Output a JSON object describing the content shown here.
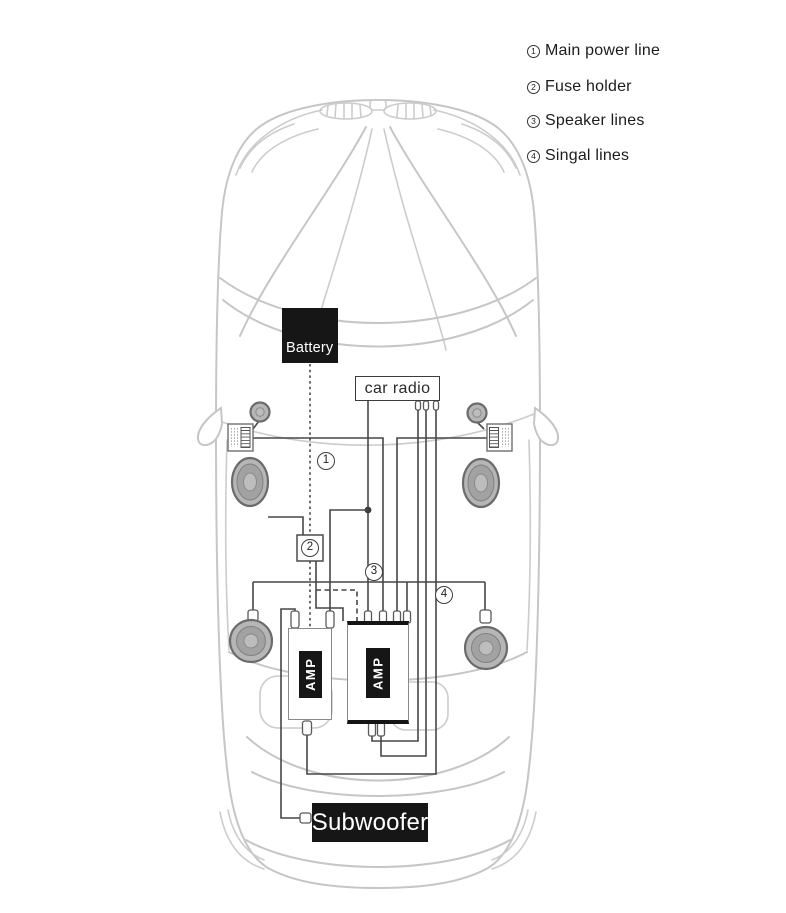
{
  "legend": {
    "items": [
      {
        "num": "1",
        "label": "Main power line"
      },
      {
        "num": "2",
        "label": "Fuse holder"
      },
      {
        "num": "3",
        "label": "Speaker lines"
      },
      {
        "num": "4",
        "label": "Singal lines"
      }
    ]
  },
  "components": {
    "battery": "Battery",
    "car_radio": "car radio",
    "amp": "AMP",
    "subwoofer": "Subwoofer"
  },
  "markers": {
    "main_power": "1",
    "fuse": "2",
    "speaker": "3",
    "signal": "4"
  },
  "colors": {
    "wire": "#474747",
    "car_outline": "#c6c6c6",
    "component_black": "#161616",
    "speaker_gray": "#b6b6b6"
  }
}
